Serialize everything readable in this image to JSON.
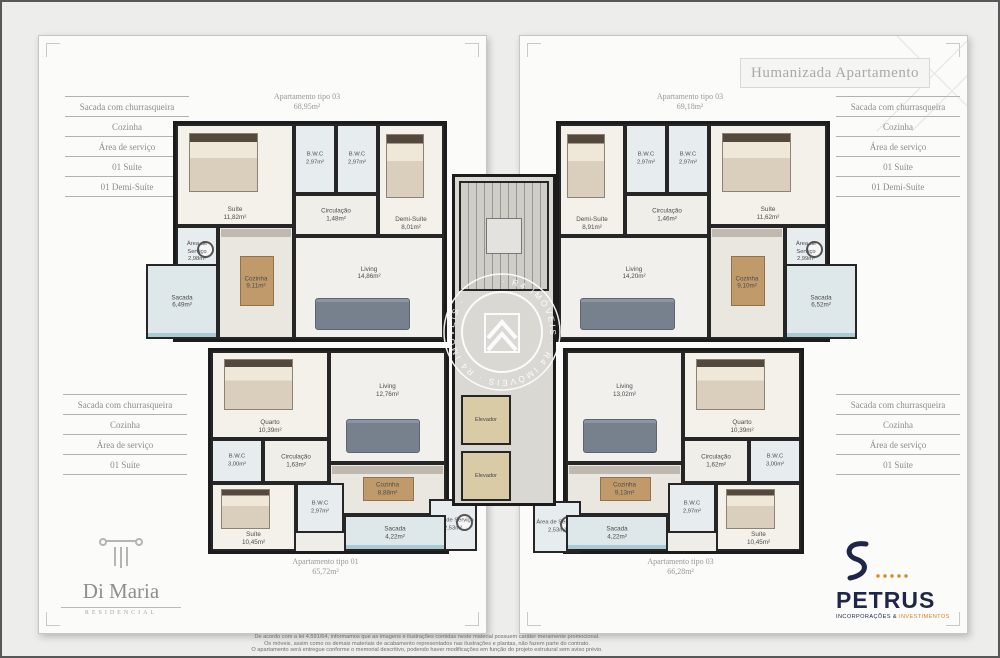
{
  "title": "Humanizada Apartamento",
  "features_top": [
    "Sacada com churrasqueira",
    "Cozinha",
    "Área de serviço",
    "01 Suíte",
    "01 Demi-Suíte"
  ],
  "features_bottom": [
    "Sacada com churrasqueira",
    "Cozinha",
    "Área de serviço",
    "01 Suíte"
  ],
  "core": {
    "elevator_label": "Elevador"
  },
  "watermark": {
    "ring_text": "· R4 IMÓVEIS · R4 IMÓVEIS · R4 IMÓVEIS ·"
  },
  "plans": [
    {
      "id": "tl",
      "caption": "Apartamento tipo 03",
      "area": "68,95m²",
      "rooms": [
        {
          "name": "Suíte",
          "area": "11,82m²",
          "kind": "bedroom",
          "rect": [
            0,
            0,
            118,
            102
          ],
          "furn": "bed"
        },
        {
          "name": "B.W.C",
          "area": "2,97m²",
          "kind": "wet",
          "rect": [
            118,
            0,
            42,
            70
          ]
        },
        {
          "name": "B.W.C",
          "area": "2,97m²",
          "kind": "wet",
          "rect": [
            160,
            0,
            42,
            70
          ]
        },
        {
          "name": "Demi-Suíte",
          "area": "8,01m²",
          "kind": "bedroom",
          "rect": [
            202,
            0,
            66,
            112
          ],
          "furn": "bed"
        },
        {
          "name": "Circulação",
          "area": "1,48m²",
          "kind": "hall",
          "rect": [
            118,
            70,
            84,
            42
          ]
        },
        {
          "name": "Área de Serviço",
          "area": "2,98m²",
          "kind": "wet",
          "rect": [
            0,
            102,
            42,
            52
          ],
          "furn": "wash"
        },
        {
          "name": "Cozinha",
          "area": "9,11m²",
          "kind": "kitchen",
          "rect": [
            42,
            102,
            76,
            113
          ],
          "furn": "dtable"
        },
        {
          "name": "Living",
          "area": "14,86m²",
          "kind": "living",
          "rect": [
            118,
            112,
            150,
            103
          ],
          "furn": "sofa"
        },
        {
          "name": "Sacada",
          "area": "6,49m²",
          "kind": "balcony",
          "rect": [
            -30,
            140,
            72,
            75
          ]
        }
      ]
    },
    {
      "id": "tr",
      "caption": "Apartamento tipo 03",
      "area": "69,18m²",
      "rooms": [
        {
          "name": "Demi-Suíte",
          "area": "8,91m²",
          "kind": "bedroom",
          "rect": [
            0,
            0,
            66,
            112
          ],
          "furn": "bed"
        },
        {
          "name": "B.W.C",
          "area": "2,97m²",
          "kind": "wet",
          "rect": [
            66,
            0,
            42,
            70
          ]
        },
        {
          "name": "B.W.C",
          "area": "2,97m²",
          "kind": "wet",
          "rect": [
            108,
            0,
            42,
            70
          ]
        },
        {
          "name": "Suíte",
          "area": "11,62m²",
          "kind": "bedroom",
          "rect": [
            150,
            0,
            118,
            102
          ],
          "furn": "bed"
        },
        {
          "name": "Circulação",
          "area": "1,46m²",
          "kind": "hall",
          "rect": [
            66,
            70,
            84,
            42
          ]
        },
        {
          "name": "Living",
          "area": "14,20m²",
          "kind": "living",
          "rect": [
            0,
            112,
            150,
            103
          ],
          "furn": "sofa"
        },
        {
          "name": "Cozinha",
          "area": "9,10m²",
          "kind": "kitchen",
          "rect": [
            150,
            102,
            76,
            113
          ],
          "furn": "dtable"
        },
        {
          "name": "Área de Serviço",
          "area": "2,99m²",
          "kind": "wet",
          "rect": [
            226,
            102,
            42,
            52
          ],
          "furn": "wash"
        },
        {
          "name": "Sacada",
          "area": "6,52m²",
          "kind": "balcony",
          "rect": [
            226,
            140,
            72,
            75
          ]
        }
      ]
    },
    {
      "id": "bl",
      "caption": "Apartamento tipo 01",
      "area": "65,72m²",
      "rooms": [
        {
          "name": "Quarto",
          "area": "10,39m²",
          "kind": "bedroom",
          "rect": [
            0,
            0,
            118,
            88
          ],
          "furn": "bed"
        },
        {
          "name": "Living",
          "area": "12,76m²",
          "kind": "living",
          "rect": [
            118,
            0,
            117,
            112
          ],
          "furn": "sofa"
        },
        {
          "name": "B.W.C",
          "area": "3,00m²",
          "kind": "wet",
          "rect": [
            0,
            88,
            52,
            44
          ]
        },
        {
          "name": "Circulação",
          "area": "1,63m²",
          "kind": "hall",
          "rect": [
            52,
            88,
            66,
            44
          ]
        },
        {
          "name": "Suíte",
          "area": "10,45m²",
          "kind": "bedroom",
          "rect": [
            0,
            132,
            85,
            68
          ],
          "furn": "bed"
        },
        {
          "name": "B.W.C",
          "area": "2,97m²",
          "kind": "wet",
          "rect": [
            85,
            132,
            48,
            50
          ]
        },
        {
          "name": "Cozinha",
          "area": "8,88m²",
          "kind": "kitchen",
          "rect": [
            118,
            112,
            117,
            52
          ],
          "furn": "dtable"
        },
        {
          "name": "Sacada",
          "area": "4,22m²",
          "kind": "balcony",
          "rect": [
            133,
            164,
            102,
            36
          ]
        },
        {
          "name": "Área de Serviço",
          "area": "2,53m²",
          "kind": "wet",
          "rect": [
            218,
            148,
            48,
            52
          ],
          "furn": "wash"
        }
      ]
    },
    {
      "id": "br",
      "caption": "Apartamento tipo 03",
      "area": "66,28m²",
      "rooms": [
        {
          "name": "Living",
          "area": "13,02m²",
          "kind": "living",
          "rect": [
            0,
            0,
            117,
            112
          ],
          "furn": "sofa"
        },
        {
          "name": "Quarto",
          "area": "10,39m²",
          "kind": "bedroom",
          "rect": [
            117,
            0,
            118,
            88
          ],
          "furn": "bed"
        },
        {
          "name": "Circulação",
          "area": "1,62m²",
          "kind": "hall",
          "rect": [
            117,
            88,
            66,
            44
          ]
        },
        {
          "name": "B.W.C",
          "area": "3,00m²",
          "kind": "wet",
          "rect": [
            183,
            88,
            52,
            44
          ]
        },
        {
          "name": "Suíte",
          "area": "10,45m²",
          "kind": "bedroom",
          "rect": [
            150,
            132,
            85,
            68
          ],
          "furn": "bed"
        },
        {
          "name": "B.W.C",
          "area": "2,97m²",
          "kind": "wet",
          "rect": [
            102,
            132,
            48,
            50
          ]
        },
        {
          "name": "Cozinha",
          "area": "9,13m²",
          "kind": "kitchen",
          "rect": [
            0,
            112,
            117,
            52
          ],
          "furn": "dtable"
        },
        {
          "name": "Sacada",
          "area": "4,22m²",
          "kind": "balcony",
          "rect": [
            0,
            164,
            102,
            36
          ]
        },
        {
          "name": "Área de Serviço",
          "area": "2,53m²",
          "kind": "wet",
          "rect": [
            -33,
            150,
            48,
            52
          ],
          "furn": "wash"
        }
      ]
    }
  ],
  "logos": {
    "di_maria": {
      "name": "Di Maria",
      "subtitle": "RESIDENCIAL"
    },
    "petrus": {
      "name": "PETRUS",
      "subtitle_left": "INCORPORAÇÕES &",
      "subtitle_right": "INVESTIMENTOS"
    }
  },
  "colors": {
    "accent_orange": "#e0821f",
    "brand_navy": "#1f2647",
    "wall": "#1c1c1c",
    "balcony_glass": "#80b2c2"
  },
  "disclaimer": [
    "De acordo com a lei 4.591/64, informamos que as imagens e ilustrações contidas neste material possuem caráter meramente promocional.",
    "Os móveis, assim como os demais materiais de acabamento representados nas ilustrações e plantas, não fazem parte do contrato.",
    "O apartamento será entregue conforme o memorial descritivo, podendo haver modificações em função do projeto estrutural sem aviso prévio."
  ]
}
